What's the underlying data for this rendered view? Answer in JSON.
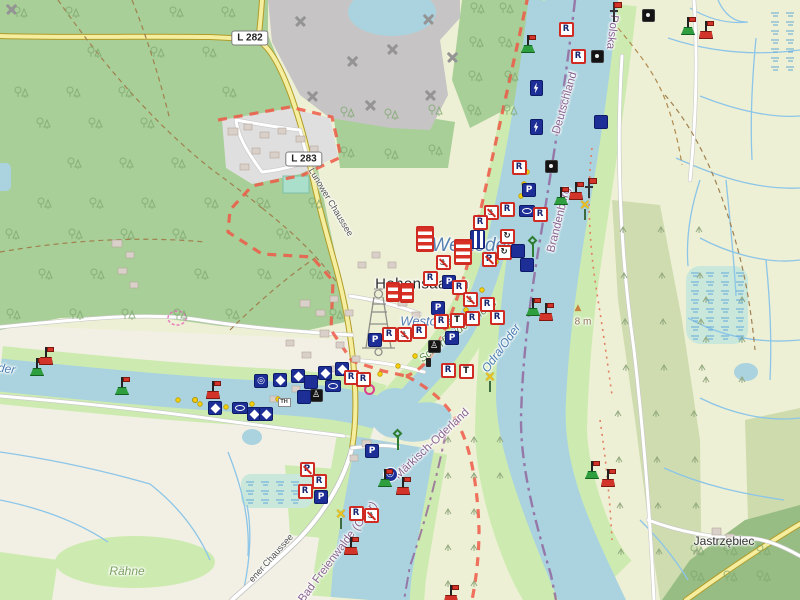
{
  "map": {
    "place_labels": [
      {
        "text": "Hohensaaten",
        "cls": "place",
        "x": 422,
        "y": 284,
        "rot": 0
      },
      {
        "text": "Jastrzębiec",
        "cls": "place2",
        "x": 724,
        "y": 541,
        "rot": 0
      },
      {
        "text": "Lunower Chaussee",
        "cls": "street",
        "x": 331,
        "y": 202,
        "rot": 59
      },
      {
        "text": "ener Chaussee",
        "cls": "street",
        "x": 271,
        "y": 558,
        "rot": -48
      },
      {
        "text": "Bad Freienwalde (Oder)",
        "cls": "boundary",
        "x": 338,
        "y": 552,
        "rot": -53
      },
      {
        "text": "Märkisch-Oderland",
        "cls": "boundary",
        "x": 432,
        "y": 444,
        "rot": -43
      },
      {
        "text": "Brandenburg",
        "cls": "boundary",
        "x": 559,
        "y": 220,
        "rot": -76
      },
      {
        "text": "Deutschland",
        "cls": "boundary",
        "x": 565,
        "y": 103,
        "rot": -74
      },
      {
        "text": "Polska",
        "cls": "boundary",
        "x": 612,
        "y": 32,
        "rot": 97
      },
      {
        "text": "Odra/Oder",
        "cls": "water",
        "x": 501,
        "y": 348,
        "rot": -54
      },
      {
        "text": "Westoder",
        "cls": "waterBig",
        "x": 472,
        "y": 246,
        "rot": 0
      },
      {
        "text": "Westoder",
        "cls": "water2",
        "x": 428,
        "y": 321,
        "rot": 0
      },
      {
        "text": "Oder",
        "cls": "water",
        "x": 2,
        "y": 368,
        "rot": 8
      },
      {
        "text": "Schorfheide-Chorin",
        "cls": "area",
        "x": 458,
        "y": 331,
        "rot": -38
      },
      {
        "text": "Rähne",
        "cls": "area2",
        "x": 127,
        "y": 571,
        "rot": 0
      },
      {
        "text": "8 m",
        "cls": "elev",
        "x": 583,
        "y": 322,
        "rot": 0
      }
    ],
    "road_badges": [
      {
        "text": "L 282",
        "x": 250,
        "y": 38
      },
      {
        "text": "L 283",
        "x": 304,
        "y": 159
      }
    ],
    "icons": {
      "p": "P",
      "r": "R",
      "t": "T",
      "anchor": "⚓",
      "turn": "↻",
      "target": "◎",
      "cross": "×",
      "peak": "▲",
      "figure": "♙",
      "info": "TH"
    },
    "markers": [
      {
        "t": "mine",
        "x": 11,
        "y": 10
      },
      {
        "t": "mine",
        "x": 300,
        "y": 22
      },
      {
        "t": "mine",
        "x": 352,
        "y": 62
      },
      {
        "t": "mine",
        "x": 312,
        "y": 97
      },
      {
        "t": "mine",
        "x": 392,
        "y": 50
      },
      {
        "t": "mine",
        "x": 428,
        "y": 20
      },
      {
        "t": "mine",
        "x": 430,
        "y": 96
      },
      {
        "t": "mine",
        "x": 370,
        "y": 106
      },
      {
        "t": "mine",
        "x": 452,
        "y": 58
      },
      {
        "t": "r",
        "x": 566,
        "y": 29
      },
      {
        "t": "r",
        "x": 578,
        "y": 56
      },
      {
        "t": "dark",
        "x": 597,
        "y": 56
      },
      {
        "t": "dark",
        "x": 648,
        "y": 15
      },
      {
        "t": "buoyG",
        "x": 688,
        "y": 26
      },
      {
        "t": "buoyR",
        "x": 706,
        "y": 30
      },
      {
        "t": "buoyG",
        "x": 528,
        "y": 44
      },
      {
        "t": "flagpole",
        "x": 614,
        "y": 12
      },
      {
        "t": "lightning",
        "x": 536,
        "y": 88
      },
      {
        "t": "lightning",
        "x": 536,
        "y": 127
      },
      {
        "t": "navy",
        "x": 601,
        "y": 122
      },
      {
        "t": "dark",
        "x": 551,
        "y": 166
      },
      {
        "t": "r",
        "x": 519,
        "y": 167
      },
      {
        "t": "buoyG",
        "x": 561,
        "y": 196
      },
      {
        "t": "buoyR",
        "x": 576,
        "y": 191
      },
      {
        "t": "flagpole",
        "x": 589,
        "y": 188
      },
      {
        "t": "xbeacon",
        "x": 585,
        "y": 211
      },
      {
        "t": "p",
        "x": 529,
        "y": 190
      },
      {
        "t": "anchor",
        "x": 491,
        "y": 212
      },
      {
        "t": "r",
        "x": 507,
        "y": 209
      },
      {
        "t": "ellipse",
        "x": 527,
        "y": 211
      },
      {
        "t": "r",
        "x": 540,
        "y": 214
      },
      {
        "t": "r",
        "x": 480,
        "y": 222
      },
      {
        "t": "circle",
        "x": 507,
        "y": 236
      },
      {
        "t": "circle",
        "x": 504,
        "y": 252
      },
      {
        "t": "vstripes",
        "x": 477,
        "y": 239
      },
      {
        "t": "hstripesBig",
        "x": 463,
        "y": 252
      },
      {
        "t": "pno",
        "x": 489,
        "y": 259
      },
      {
        "t": "navy",
        "x": 518,
        "y": 251
      },
      {
        "t": "navy",
        "x": 527,
        "y": 265
      },
      {
        "t": "hstripesBig",
        "x": 425,
        "y": 239
      },
      {
        "t": "anchor",
        "x": 443,
        "y": 262
      },
      {
        "t": "r",
        "x": 430,
        "y": 278
      },
      {
        "t": "p",
        "x": 449,
        "y": 282
      },
      {
        "t": "hstripes",
        "x": 393,
        "y": 292
      },
      {
        "t": "hstripes",
        "x": 407,
        "y": 293
      },
      {
        "t": "r",
        "x": 459,
        "y": 287
      },
      {
        "t": "anchor",
        "x": 470,
        "y": 299
      },
      {
        "t": "r",
        "x": 487,
        "y": 304
      },
      {
        "t": "r",
        "x": 497,
        "y": 317
      },
      {
        "t": "p",
        "x": 438,
        "y": 308
      },
      {
        "t": "r",
        "x": 441,
        "y": 321
      },
      {
        "t": "t",
        "x": 457,
        "y": 320
      },
      {
        "t": "r",
        "x": 472,
        "y": 318
      },
      {
        "t": "r",
        "x": 419,
        "y": 331
      },
      {
        "t": "anchor",
        "x": 404,
        "y": 334
      },
      {
        "t": "r",
        "x": 389,
        "y": 334
      },
      {
        "t": "darkfig",
        "x": 434,
        "y": 346
      },
      {
        "t": "p",
        "x": 452,
        "y": 338
      },
      {
        "t": "bollard",
        "x": 428,
        "y": 362
      },
      {
        "t": "r",
        "x": 448,
        "y": 370
      },
      {
        "t": "t",
        "x": 466,
        "y": 371
      },
      {
        "t": "p",
        "x": 375,
        "y": 340
      },
      {
        "t": "marina",
        "x": 369,
        "y": 389
      },
      {
        "t": "diamond",
        "x": 215,
        "y": 408
      },
      {
        "t": "ellipse",
        "x": 240,
        "y": 408
      },
      {
        "t": "diamond",
        "x": 254,
        "y": 414
      },
      {
        "t": "diamond",
        "x": 266,
        "y": 414
      },
      {
        "t": "circle2",
        "x": 261,
        "y": 381
      },
      {
        "t": "diamond",
        "x": 280,
        "y": 380
      },
      {
        "t": "diamond",
        "x": 298,
        "y": 376
      },
      {
        "t": "navy",
        "x": 311,
        "y": 382
      },
      {
        "t": "diamond",
        "x": 325,
        "y": 373
      },
      {
        "t": "diamond",
        "x": 342,
        "y": 369
      },
      {
        "t": "r",
        "x": 351,
        "y": 377
      },
      {
        "t": "r",
        "x": 363,
        "y": 379
      },
      {
        "t": "ellipse",
        "x": 333,
        "y": 386
      },
      {
        "t": "darkfig",
        "x": 316,
        "y": 395
      },
      {
        "t": "info",
        "x": 284,
        "y": 402
      },
      {
        "t": "navy",
        "x": 304,
        "y": 397
      },
      {
        "t": "buoyR",
        "x": 213,
        "y": 390
      },
      {
        "t": "buoyG",
        "x": 122,
        "y": 386
      },
      {
        "t": "buoyG",
        "x": 37,
        "y": 367
      },
      {
        "t": "buoyR",
        "x": 46,
        "y": 356
      },
      {
        "t": "dot",
        "x": 195,
        "y": 400
      },
      {
        "t": "p",
        "x": 372,
        "y": 451
      },
      {
        "t": "pno",
        "x": 307,
        "y": 469
      },
      {
        "t": "r",
        "x": 319,
        "y": 481
      },
      {
        "t": "r",
        "x": 305,
        "y": 491
      },
      {
        "t": "p",
        "x": 321,
        "y": 497
      },
      {
        "t": "r",
        "x": 356,
        "y": 513
      },
      {
        "t": "anchor",
        "x": 371,
        "y": 515
      },
      {
        "t": "circleblue",
        "x": 390,
        "y": 474
      },
      {
        "t": "xbeacon",
        "x": 341,
        "y": 520
      },
      {
        "t": "buoyG",
        "x": 385,
        "y": 478
      },
      {
        "t": "buoyR",
        "x": 403,
        "y": 486
      },
      {
        "t": "buoyR",
        "x": 351,
        "y": 546
      },
      {
        "t": "buoyG",
        "x": 592,
        "y": 470
      },
      {
        "t": "buoyR",
        "x": 608,
        "y": 478
      },
      {
        "t": "buoyG",
        "x": 533,
        "y": 307
      },
      {
        "t": "buoyR",
        "x": 546,
        "y": 312
      },
      {
        "t": "buoyR",
        "x": 451,
        "y": 594
      },
      {
        "t": "beaconD",
        "x": 533,
        "y": 247
      },
      {
        "t": "beaconD",
        "x": 398,
        "y": 440
      },
      {
        "t": "xbeacon",
        "x": 490,
        "y": 383
      },
      {
        "t": "peak",
        "x": 578,
        "y": 308
      }
    ],
    "colors": {
      "water": "#aad3df",
      "forest": "#a8cf97",
      "farmland": "#eef0d5",
      "grass": "#cdebb0",
      "scrub": "#c9d8a8",
      "quarry": "#c6c4c4",
      "residential": "#e0dfdf",
      "pitch": "#aae0cb",
      "road_yellow": "#f5ee9e",
      "road_white": "#ffffff",
      "reserve_red": "#ee5947",
      "boundary_purple": "#8f5a96",
      "sign_navy": "#1d2f97",
      "sign_red": "#cf2b23",
      "buoy_green": "#2f9e3f",
      "buoy_red": "#d2342a",
      "beacon_yellow": "#eec21c",
      "elevation_orange": "#c9823e",
      "marina_pink": "#e0218a"
    }
  }
}
